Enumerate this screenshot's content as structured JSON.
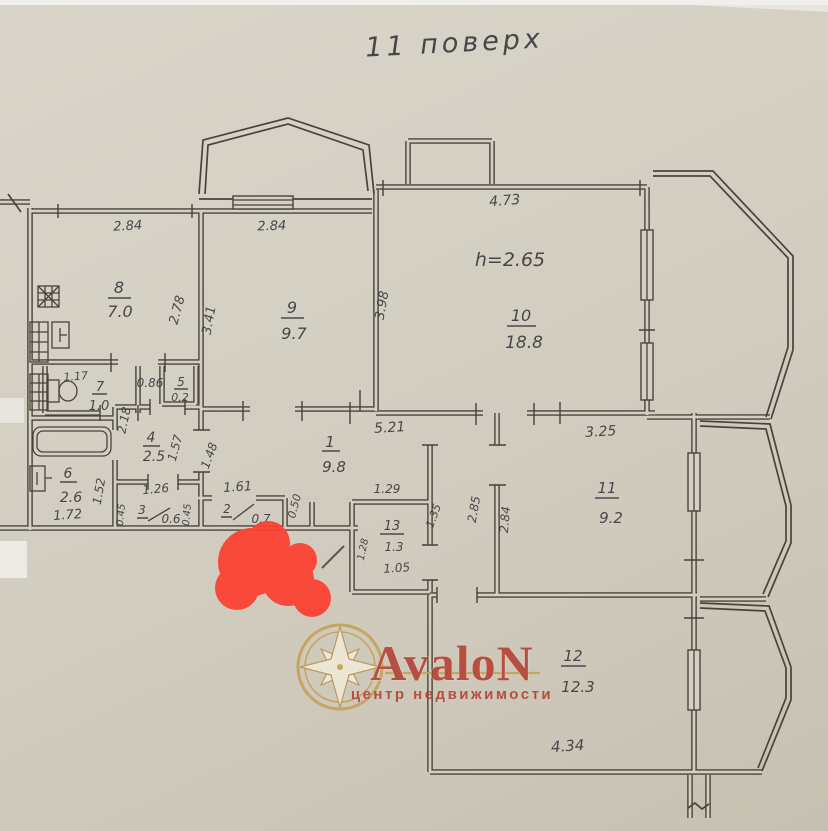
{
  "page": {
    "title": "11 поверх"
  },
  "plan": {
    "ceiling_height": "h=2.65",
    "rooms": {
      "r1": {
        "number": "1",
        "area": "9.8"
      },
      "r2": {
        "number": "2",
        "area": "0.7"
      },
      "r3": {
        "number": "3",
        "area": "0.6"
      },
      "r4": {
        "number": "4",
        "area": "2.5"
      },
      "r5": {
        "number": "5",
        "area": "0.2"
      },
      "r6": {
        "number": "6",
        "area": "2.6"
      },
      "r7": {
        "number": "7",
        "area": "1.0"
      },
      "r8": {
        "number": "8",
        "area": "7.0"
      },
      "r9": {
        "number": "9",
        "area": "9.7"
      },
      "r10": {
        "number": "10",
        "area": "18.8"
      },
      "r11": {
        "number": "11",
        "area": "9.2"
      },
      "r12": {
        "number": "12",
        "area": "12.3"
      },
      "r13": {
        "number": "13",
        "area": "1.3"
      }
    },
    "dims": {
      "kitchen_width": "2.84",
      "kitchen_depth": "2.78",
      "room9_width": "2.84",
      "room9_depth": "3.41",
      "room10_width": "4.73",
      "room10_depth": "3.98",
      "wc_width": "1.17",
      "lobby_width": "0.86",
      "hall_depth": "2.18",
      "hall_inner_depth": "1.57",
      "hall_width": "1.26",
      "corridor_left": "1.48",
      "bath_width": "1.72",
      "bath_depth": "1.52",
      "closet3_jamb": "0.45",
      "closet2_jamb": "0.45",
      "closet2_width": "1.61",
      "closet2_right": "0.50",
      "corridor_width": "5.21",
      "pantry_width": "1.29",
      "pantry_depth": "1.28",
      "pantry_inner_width": "1.05",
      "passage_jamb": "1.35",
      "passage_depth": "2.85",
      "room11_depth": "2.84",
      "room11_width": "3.25",
      "room12_width": "4.34"
    }
  },
  "watermark": {
    "brand": "AvaloN",
    "tagline": "центр недвижимости"
  },
  "colors": {
    "marker_red": "#fb4334",
    "brand_red": "#b23a2e",
    "gold": "#c3a052",
    "ink": "#49443b",
    "paper": "#d5d0c4"
  }
}
